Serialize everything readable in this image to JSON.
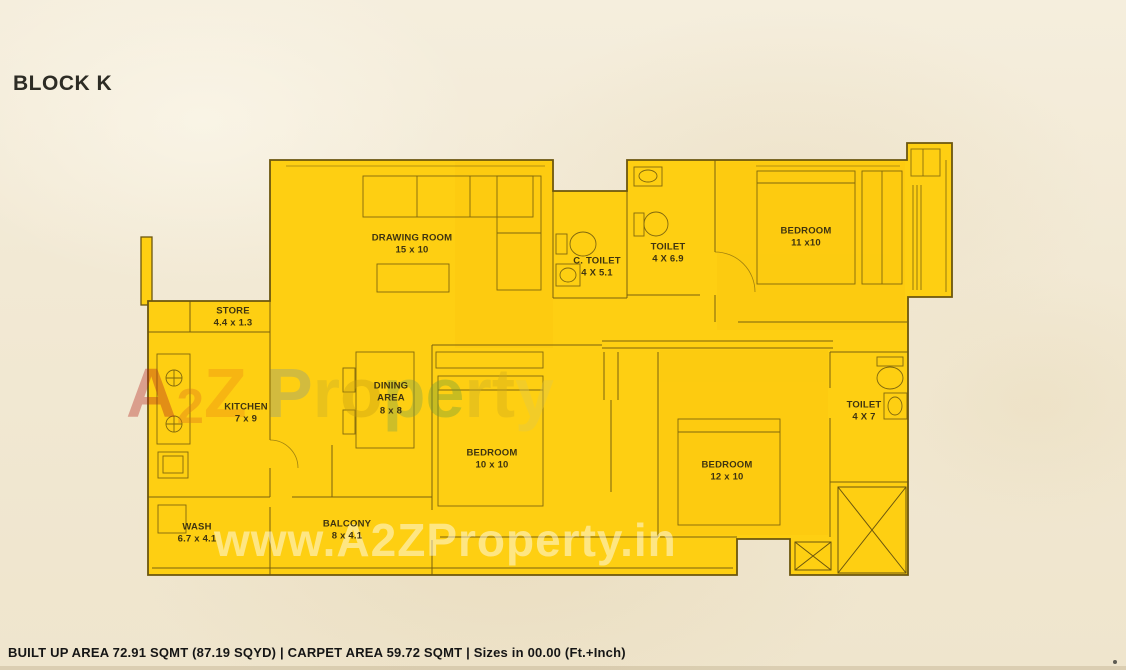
{
  "page": {
    "title": "BLOCK K",
    "footer": "BUILT UP AREA 72.91 SQMT (87.19 SQYD) | CARPET AREA 59.72 SQMT | Sizes in 00.00 (Ft.+Inch)"
  },
  "plan": {
    "fill": "#fecf12",
    "wall": "#6b560e",
    "background": "#f2e9d4"
  },
  "rooms": [
    {
      "name": "DRAWING ROOM",
      "size": "15 x 10"
    },
    {
      "name": "C. TOILET",
      "size": "4 X 5.1"
    },
    {
      "name": "TOILET",
      "size": "4 X 6.9"
    },
    {
      "name": "BEDROOM",
      "size": "11 x10"
    },
    {
      "name": "STORE",
      "size": "4.4 x 1.3"
    },
    {
      "name": "KITCHEN",
      "size": "7 x 9"
    },
    {
      "name": "DINING AREA",
      "size": "8 x 8"
    },
    {
      "name": "BEDROOM",
      "size": "10 x 10"
    },
    {
      "name": "BEDROOM",
      "size": "12 x 10"
    },
    {
      "name": "TOILET",
      "size": "4 X 7"
    },
    {
      "name": "WASH",
      "size": "6.7 x 4.1"
    },
    {
      "name": "BALCONY",
      "size": "8 x 4.1"
    }
  ],
  "watermark": {
    "center_text": "A2Z Property",
    "bottom": "www.A2ZProperty.in",
    "center_letters": [
      {
        "ch": "A",
        "color": "#b5271e",
        "small": false
      },
      {
        "ch": "2",
        "color": "#e0761b",
        "small": true
      },
      {
        "ch": "Z",
        "color": "#ee8d12",
        "small": false
      },
      {
        "ch": " ",
        "color": "#000000",
        "small": false
      },
      {
        "ch": "P",
        "color": "#8d9c85",
        "small": false
      },
      {
        "ch": "r",
        "color": "#c9ae2a",
        "small": false
      },
      {
        "ch": "o",
        "color": "#c79e12",
        "small": false
      },
      {
        "ch": "p",
        "color": "#7fa34e",
        "small": false
      },
      {
        "ch": "e",
        "color": "#6f9e3a",
        "small": false
      },
      {
        "ch": "r",
        "color": "#c9ae2a",
        "small": false
      },
      {
        "ch": "t",
        "color": "#d1ad1f",
        "small": false
      },
      {
        "ch": "y",
        "color": "#e0c84e",
        "small": false
      }
    ]
  }
}
